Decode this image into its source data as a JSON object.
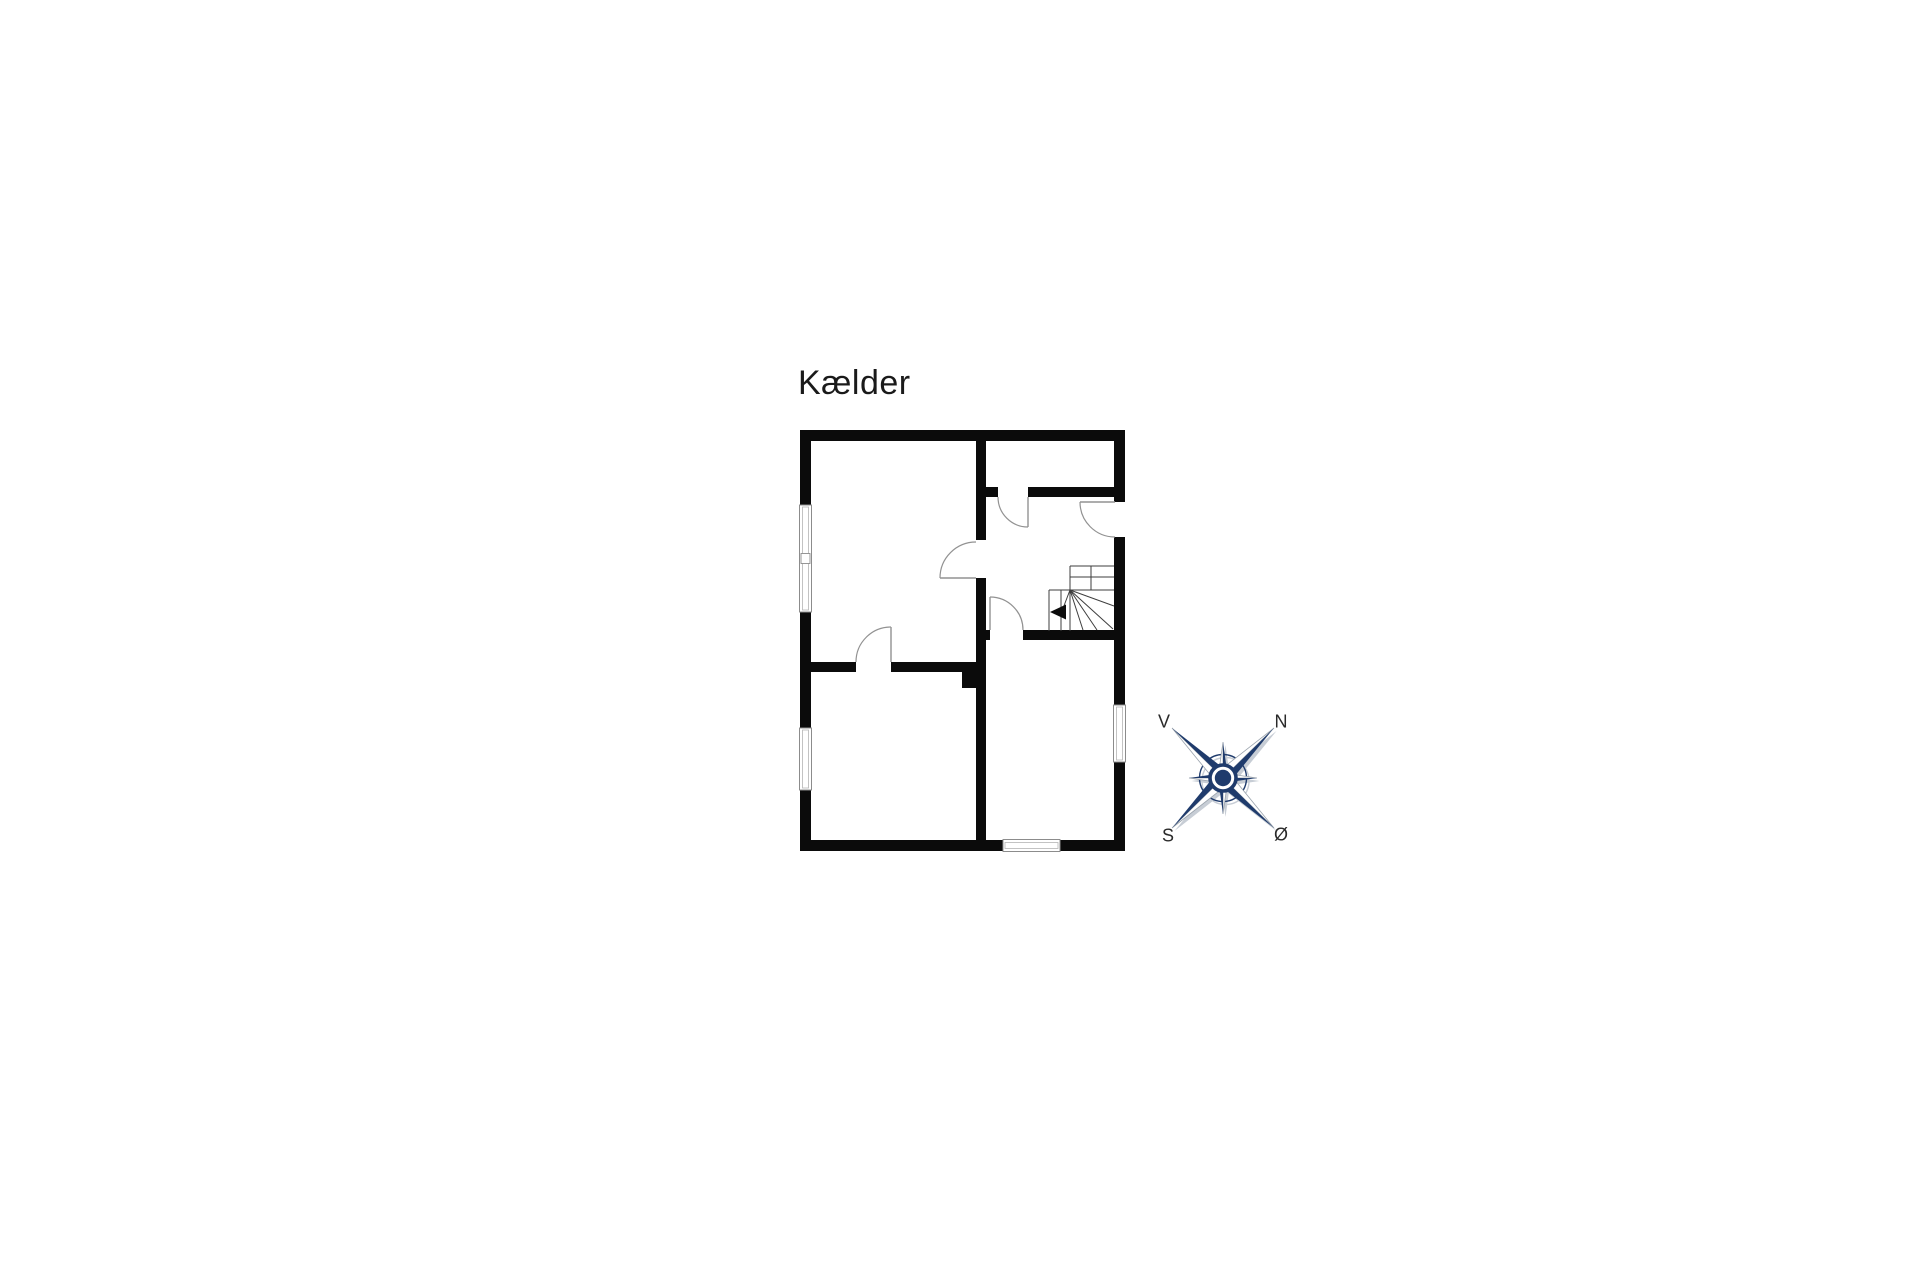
{
  "title": {
    "text": "Kælder"
  },
  "compass": {
    "labels": {
      "west": "V",
      "north": "N",
      "south": "S",
      "east": "Ø"
    }
  },
  "colors": {
    "text": "#1a1a1a",
    "wall": "#0b0b0b",
    "door": "#929292",
    "stair": "#3d3d3d",
    "winb": "#8c8c8c",
    "winl": "#b5b5b5",
    "compass_primary": "#1f3b6c",
    "compass_shadow": "#c7cdd5",
    "compass_outline": "#9aa3ad"
  },
  "plan": {
    "walls": [
      [
        800,
        430,
        325,
        11
      ],
      [
        800,
        840,
        325,
        11
      ],
      [
        800,
        430,
        11,
        421
      ],
      [
        1114,
        430,
        11,
        421
      ],
      [
        976,
        430,
        10,
        110
      ],
      [
        976,
        578,
        10,
        273
      ],
      [
        986,
        487,
        12,
        10
      ],
      [
        1028,
        487,
        86,
        10
      ],
      [
        986,
        630,
        4,
        10
      ],
      [
        1023,
        630,
        91,
        10
      ],
      [
        800,
        662,
        56,
        10
      ],
      [
        891,
        662,
        85,
        10
      ],
      [
        962,
        662,
        24,
        26
      ]
    ],
    "openings": [
      [
        1114,
        502,
        11,
        35
      ]
    ],
    "windows": [
      {
        "x": 799.5,
        "y": 505,
        "w": 12,
        "h": 107,
        "mullion": true
      },
      {
        "x": 799.5,
        "y": 728,
        "w": 12,
        "h": 62
      },
      {
        "x": 1113.5,
        "y": 705,
        "w": 12,
        "h": 57
      },
      {
        "x": 1003,
        "y": 839.5,
        "w": 57,
        "h": 12
      }
    ],
    "doors": [
      {
        "hinge": [
          1028,
          497
        ],
        "leaf": [
          1028,
          527
        ],
        "from": [
          998,
          497
        ],
        "r": 30,
        "sweep": 0
      },
      {
        "hinge": [
          1115,
          502
        ],
        "leaf": [
          1080,
          502
        ],
        "from": [
          1115,
          537
        ],
        "r": 35,
        "sweep": 1
      },
      {
        "hinge": [
          976,
          578
        ],
        "leaf": [
          940,
          578
        ],
        "from": [
          976,
          542
        ],
        "r": 36,
        "sweep": 0
      },
      {
        "hinge": [
          990,
          630
        ],
        "leaf": [
          990,
          597
        ],
        "from": [
          1023,
          630
        ],
        "r": 33,
        "sweep": 0
      },
      {
        "hinge": [
          891,
          662
        ],
        "leaf": [
          891,
          627
        ],
        "from": [
          856,
          662
        ],
        "r": 35,
        "sweep": 1
      }
    ],
    "stairs": {
      "lines": [
        [
          1070,
          566,
          1114,
          566
        ],
        [
          1070,
          577,
          1114,
          577
        ],
        [
          1049,
          590,
          1114,
          590
        ],
        [
          1070,
          566,
          1070,
          590
        ],
        [
          1091,
          566,
          1091,
          590
        ],
        [
          1049,
          590,
          1049,
          631
        ],
        [
          1061,
          590,
          1061,
          631
        ],
        [
          1070,
          590,
          1070,
          631
        ],
        [
          1070,
          590,
          1114,
          606
        ],
        [
          1070,
          590,
          1113,
          629
        ],
        [
          1070,
          590,
          1097,
          630
        ],
        [
          1070,
          590,
          1083,
          630
        ],
        [
          1070,
          590,
          1062,
          611
        ]
      ],
      "arrow": "1050,612 1066,604.5 1066,619.5"
    }
  }
}
